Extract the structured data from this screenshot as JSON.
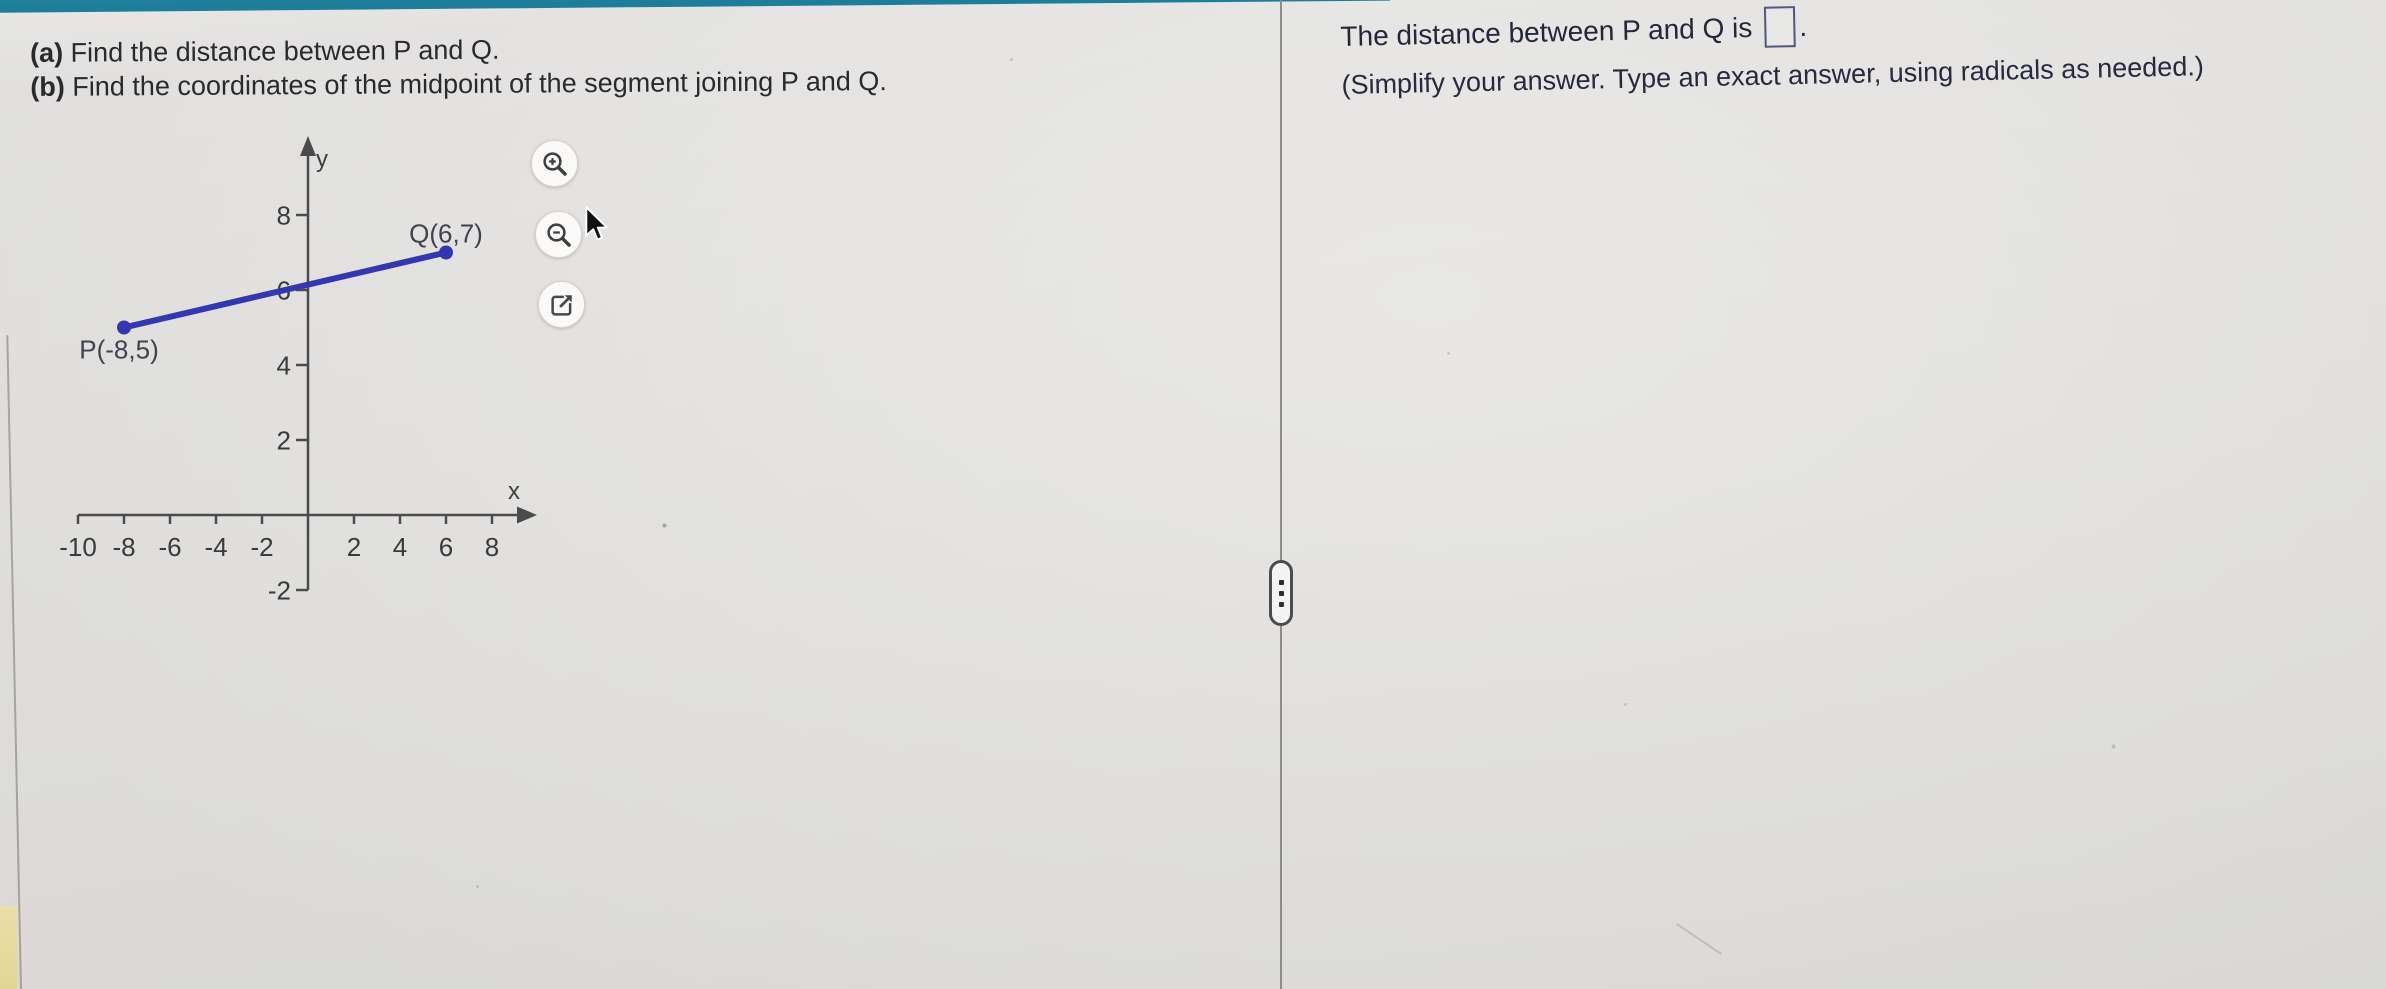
{
  "page": {
    "background_color": "#e6e5e3",
    "top_bar_color": "#1f809b"
  },
  "problem": {
    "part_a_prefix": "(a)",
    "part_a_text": " Find the distance between P and Q.",
    "part_b_prefix": "(b)",
    "part_b_text": " Find the coordinates of the midpoint of the segment joining P and Q."
  },
  "answer_panel": {
    "statement_before_box": "The distance between P and Q is",
    "answer_value": "",
    "statement_after_box": ".",
    "instruction": "(Simplify your answer. Type an exact answer, using radicals as needed.)"
  },
  "graph_tools": {
    "zoom_in_icon": "magnifier-plus",
    "zoom_out_icon": "magnifier-minus",
    "open_icon": "open-graph-in-new-window"
  },
  "divider": {
    "handle_dots": 3
  },
  "chart_data": {
    "type": "scatter",
    "points": [
      {
        "label": "P(-8,5)",
        "x": -8,
        "y": 5,
        "label_dx": -5,
        "label_dy": 31
      },
      {
        "label": "Q(6,7)",
        "x": 6,
        "y": 7,
        "label_dx": 0,
        "label_dy": -10
      }
    ],
    "segment_between_points": true,
    "x_ticks": [
      -10,
      -8,
      -6,
      -4,
      -2,
      2,
      4,
      6,
      8
    ],
    "y_ticks": [
      8,
      6,
      4,
      2,
      -2
    ],
    "xlabel": "x",
    "ylabel": "y",
    "xlim": [
      -10,
      9.5
    ],
    "ylim": [
      -2,
      10
    ],
    "grid": false,
    "line_color": "#3437b2",
    "axis_color": "#4b4b4b"
  }
}
